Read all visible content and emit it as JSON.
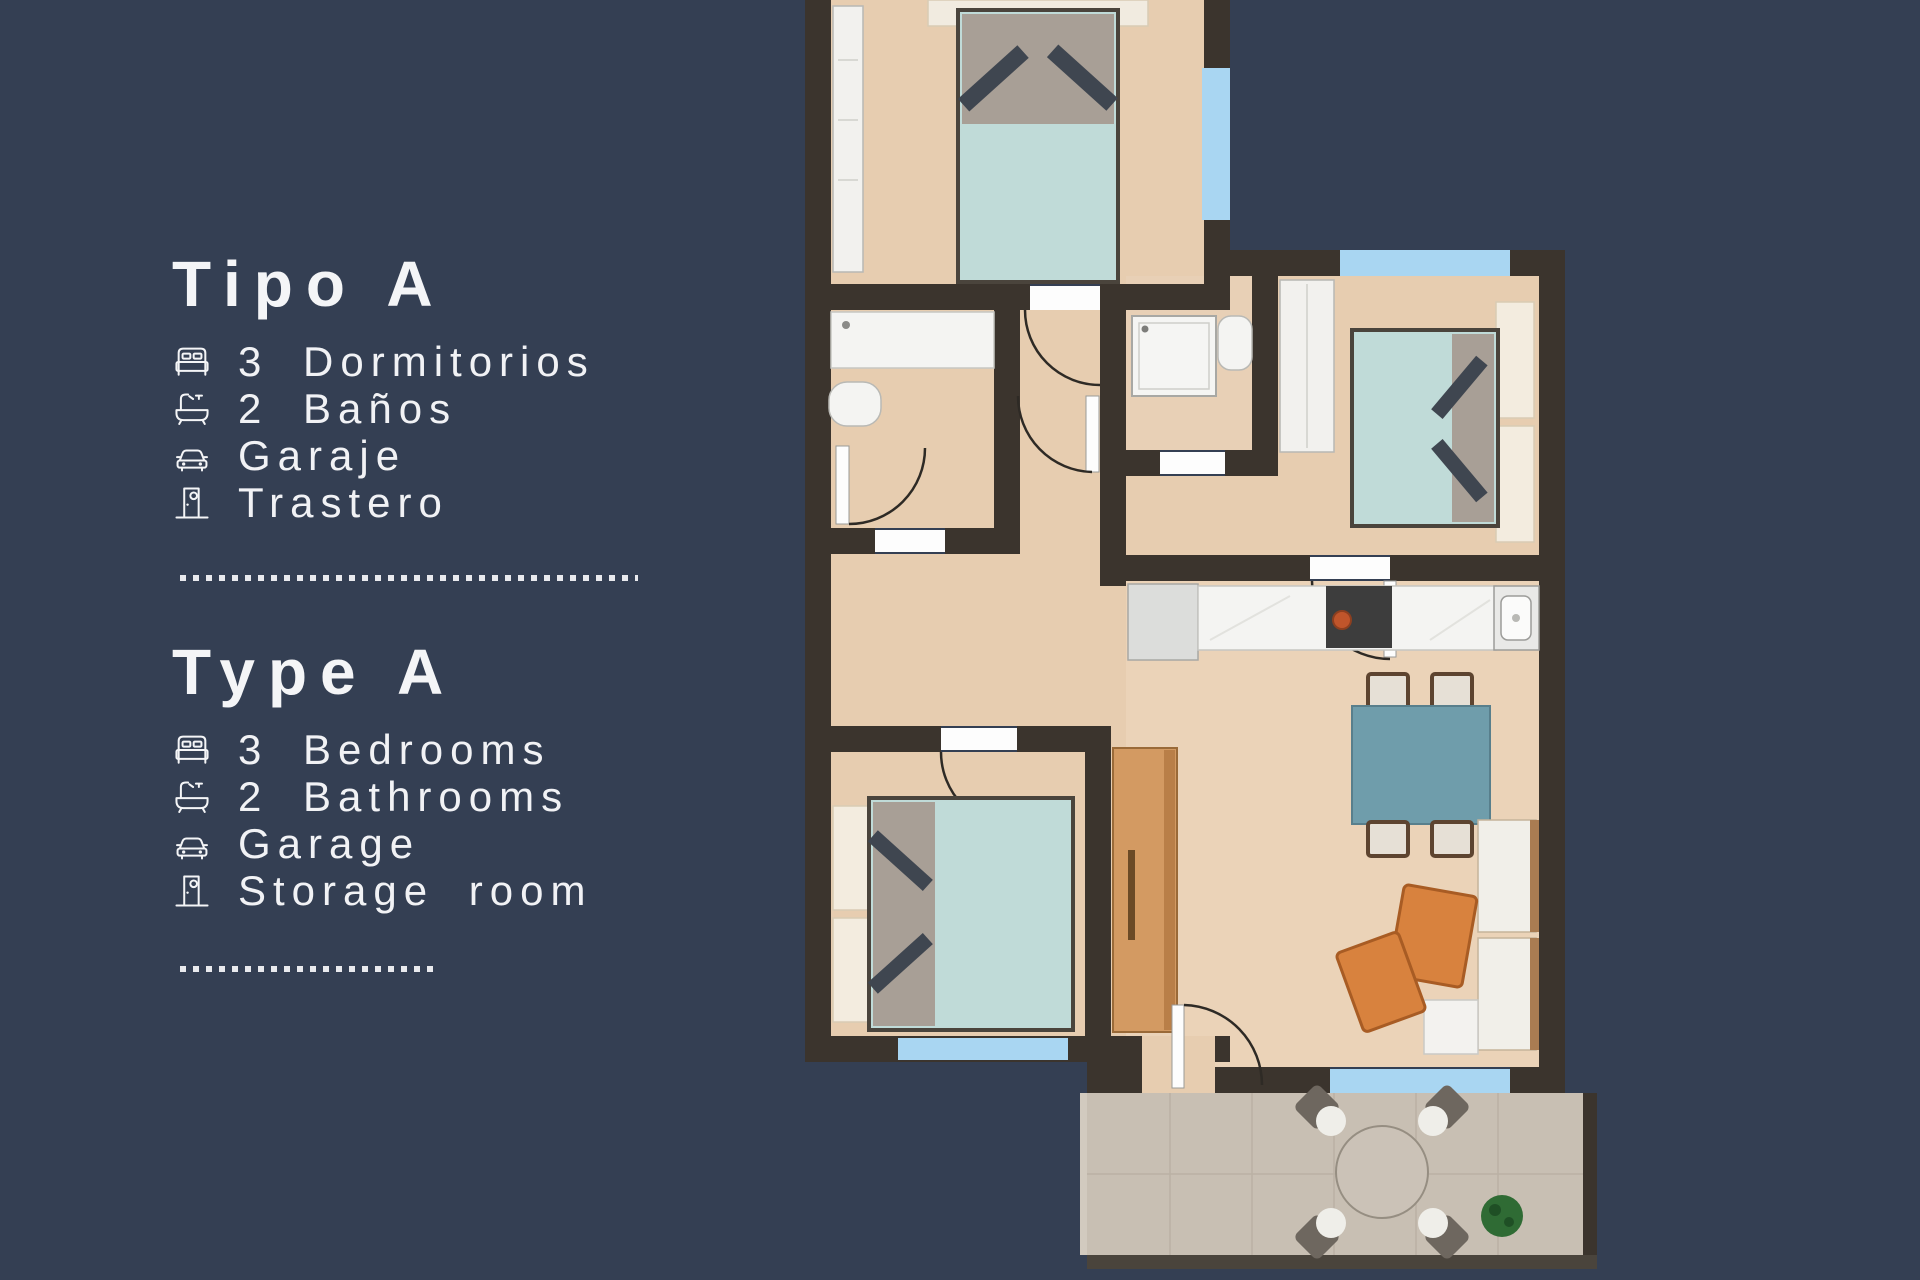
{
  "panel": {
    "sections": [
      {
        "title": "Tipo A",
        "items": [
          {
            "icon": "bed-icon",
            "label": "3 Dormitorios"
          },
          {
            "icon": "bathtub-icon",
            "label": "2 Baños"
          },
          {
            "icon": "car-icon",
            "label": "Garaje"
          },
          {
            "icon": "door-icon",
            "label": "Trastero"
          }
        ]
      },
      {
        "title": "Type A",
        "items": [
          {
            "icon": "bed-icon",
            "label": "3 Bedrooms"
          },
          {
            "icon": "bathtub-icon",
            "label": "2 Bathrooms"
          },
          {
            "icon": "car-icon",
            "label": "Garage"
          },
          {
            "icon": "door-icon",
            "label": "Storage room"
          }
        ]
      }
    ]
  },
  "colors": {
    "background": "#343f53",
    "text": "#f4f5f7",
    "wall": "#3b342d",
    "floor": "#e7cdb0",
    "window_blue": "#a9d6f2",
    "bed_teal": "#c0dbd8",
    "dining_table_teal": "#6f9dab",
    "sofa_orange": "#d8823e",
    "wardrobe_wood": "#d39a62",
    "terrace_tile": "#c8bfb3",
    "plant_green": "#2f6b34",
    "fixture_white": "#f4f4f2"
  }
}
